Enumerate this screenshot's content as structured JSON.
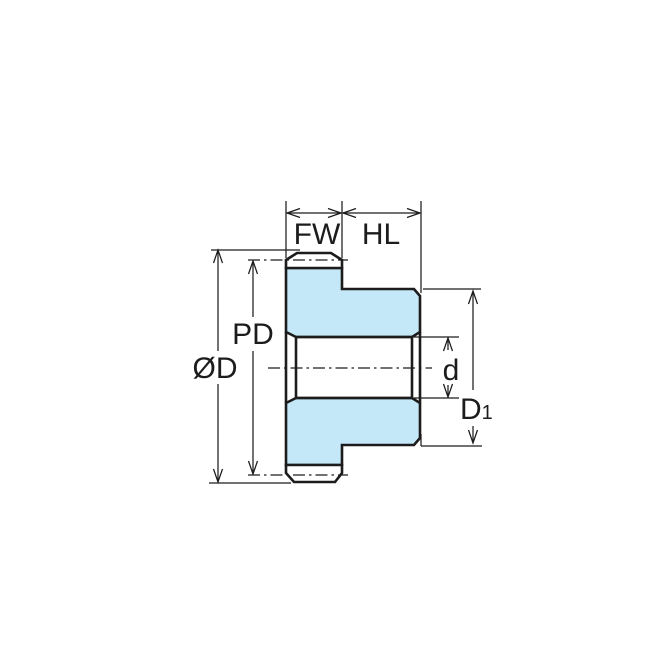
{
  "colors": {
    "background": "#ffffff",
    "part_fill": "#c5e8f8",
    "line": "#1c1c1c"
  },
  "diagram": {
    "labels": {
      "face_width": "FW",
      "hub_length": "HL",
      "pitch_diameter": "PD",
      "outside_diameter": "ØD",
      "bore_diameter": "d",
      "hub_diameter_main": "D",
      "hub_diameter_sub": "1"
    }
  }
}
